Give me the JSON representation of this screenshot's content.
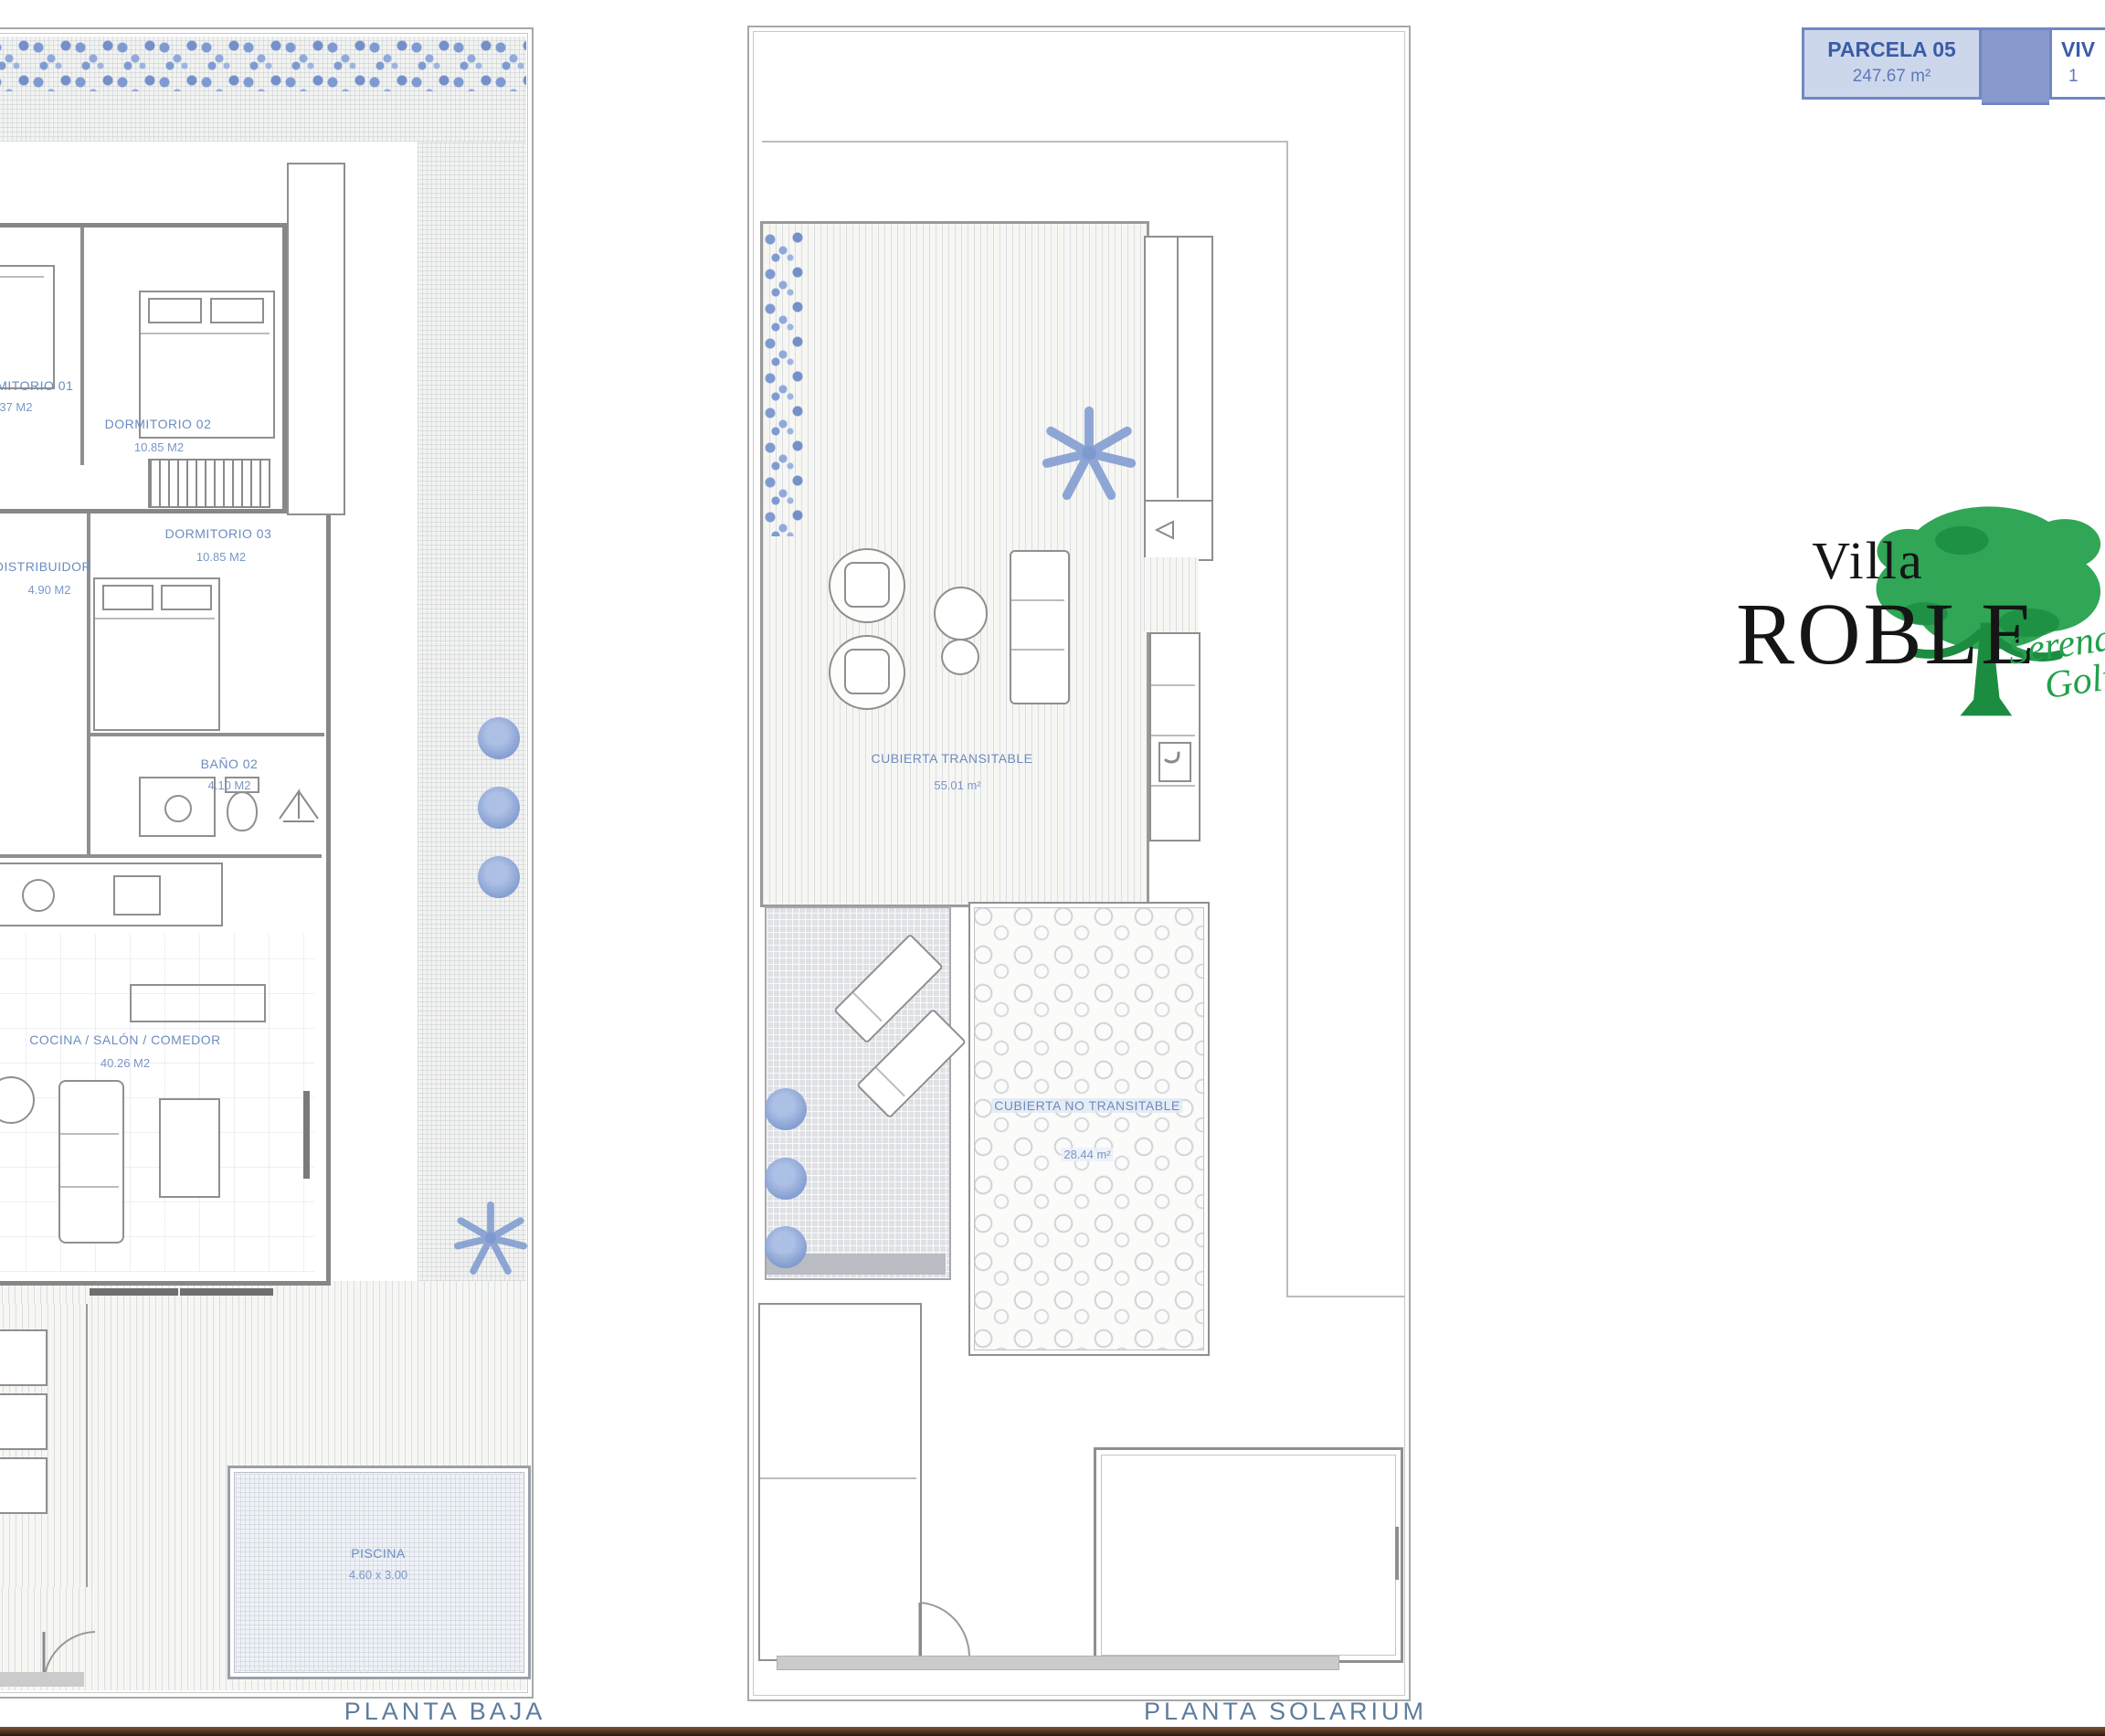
{
  "info_boxes": {
    "parcela": {
      "title": "PARCELA 05",
      "area": "247.67 m²"
    },
    "vivienda": {
      "title": "VIV",
      "value": "1"
    }
  },
  "logo": {
    "villa": "Villa",
    "roble": "ROBLE",
    "script_line1": "Serena",
    "script_line2": "Golf"
  },
  "planta_baja": {
    "title": "PLANTA BAJA",
    "rooms": {
      "dormitorio1": {
        "name": "DORMITORIO 01",
        "area": "8.37 M2"
      },
      "dormitorio2": {
        "name": "DORMITORIO 02",
        "area": "10.85 M2"
      },
      "dormitorio3": {
        "name": "DORMITORIO 03",
        "area": "10.85 M2"
      },
      "distribuidor": {
        "name": "DISTRIBUIDOR",
        "area": "4.90 M2"
      },
      "bano2": {
        "name": "BAÑO 02",
        "area": "4.10 M2"
      },
      "cocina": {
        "name": "COCINA / SALÓN / COMEDOR",
        "area": "40.26 M2"
      },
      "piscina": {
        "name": "PISCINA",
        "area": "4.60 x 3.00"
      }
    }
  },
  "planta_solarium": {
    "title": "PLANTA SOLARIUM",
    "areas": {
      "transitable": {
        "name": "CUBIERTA TRANSITABLE",
        "area": "55.01 m²"
      },
      "no_transitable": {
        "name": "CUBIERTA NO TRANSITABLE",
        "area": "28.44 m²"
      }
    }
  },
  "colors": {
    "accent_blue": "#7187c2",
    "label_blue": "#6b8cc0",
    "logo_green": "#22a04c",
    "plan_line": "#8a8a8a",
    "footer_brown": "#33200f"
  }
}
